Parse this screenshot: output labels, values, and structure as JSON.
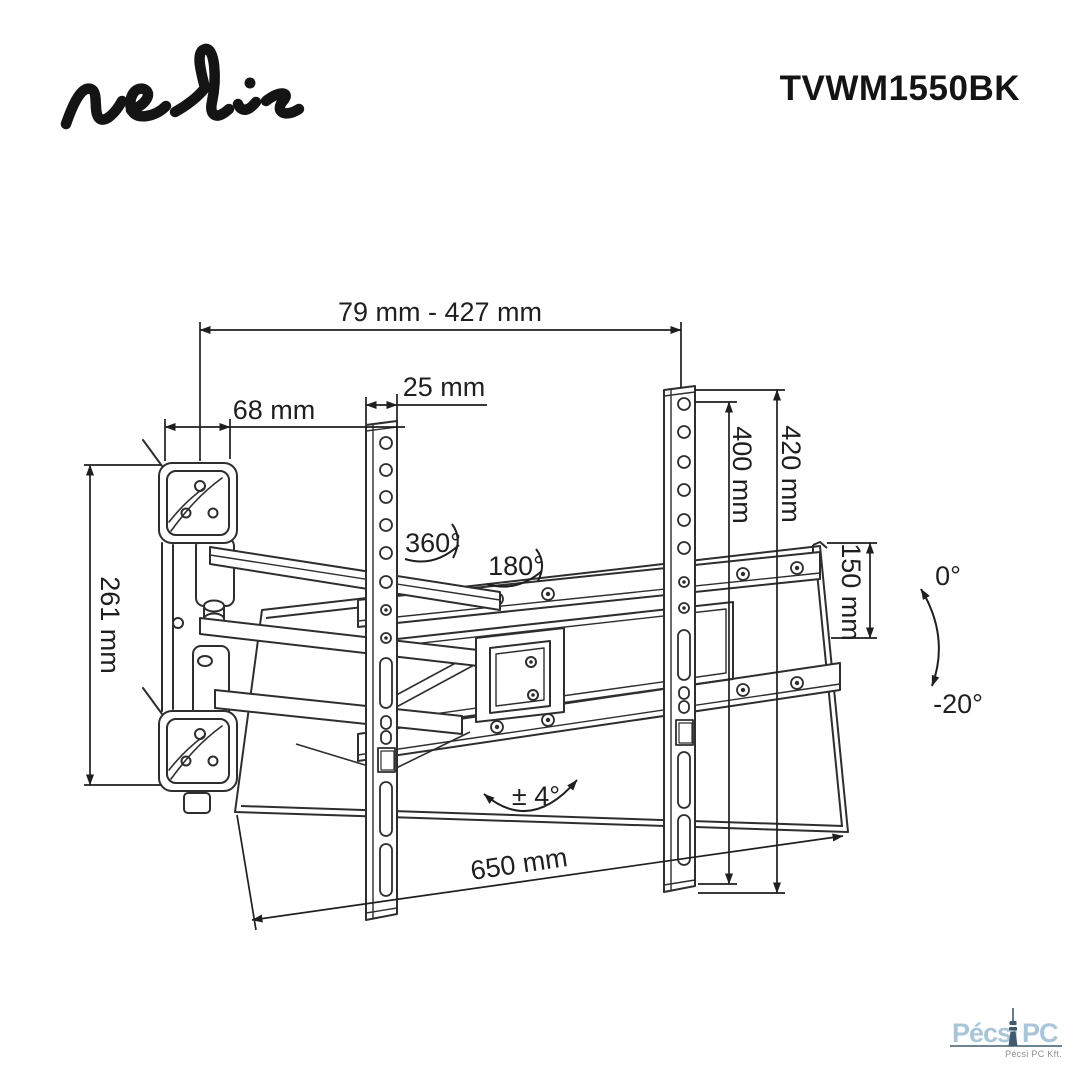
{
  "header": {
    "logo_text": "nedis",
    "model_number": "TVWM1550BK"
  },
  "dimensions": {
    "extension_range": "79 mm - 427 mm",
    "rail_width": "25 mm",
    "wall_plate_depth": "68 mm",
    "wall_plate_height": "261 mm",
    "vesa_hole_height": "400 mm",
    "rail_height": "420 mm",
    "bracket_side_height": "150 mm",
    "bracket_width": "650 mm"
  },
  "angles": {
    "swivel_joint": "360°",
    "swivel_plate": "180°",
    "level_adjustment": "± 4°",
    "tilt_max": "0°",
    "tilt_min": "-20°"
  },
  "style": {
    "line_color": "#2e2e2e",
    "dim_text_color": "#1f1f1f"
  },
  "watermark": {
    "brand_primary": "Pécsi",
    "brand_secondary": "PC",
    "company": "Pécsi PC Kft.",
    "brand_color": "#a9c6d8",
    "icon_color": "#3f5a6d",
    "company_color": "#8b9196"
  }
}
